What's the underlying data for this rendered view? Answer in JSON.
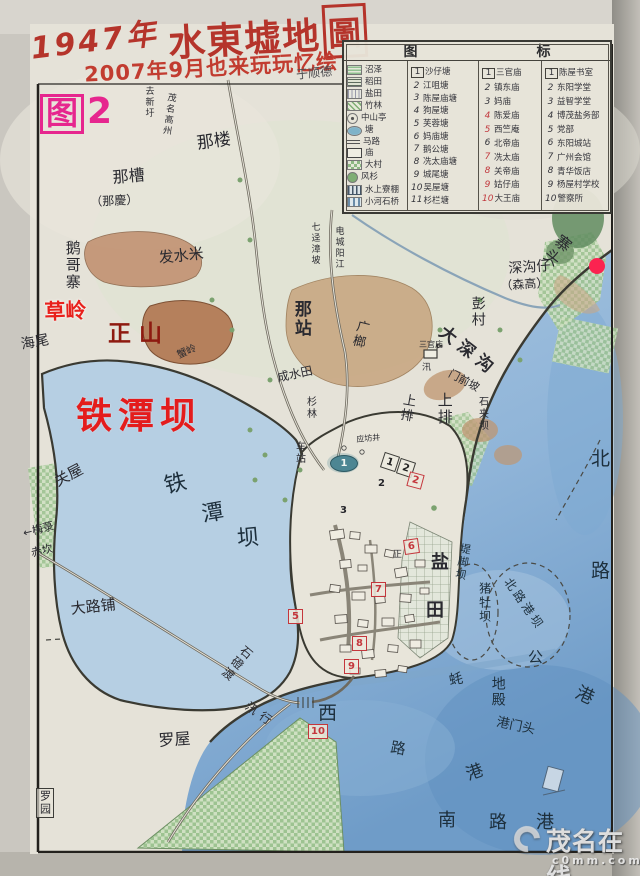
{
  "colors": {
    "paper": "#e5e2d8",
    "sea": "#9fc0dc",
    "lake": "#b6cfe3",
    "deep_sea": "#6f9cc8",
    "title_red": "#b5342b",
    "figure_magenta": "#e6268e",
    "overlay_red": "#e41c1c",
    "overlay_dark_red": "#8e1a10",
    "red_dot": "#fb2350",
    "ink": "#2a2a30"
  },
  "title": {
    "year": "1947年",
    "main": "水東墟地",
    "main_boxed": "圖",
    "subtitle": "2007年9月也来玩玩忆绘",
    "signature": "于顺德"
  },
  "figure": {
    "label": "图",
    "number": "2"
  },
  "legend": {
    "header_left": "图",
    "header_right": "标",
    "symbols": [
      {
        "icon": "marsh",
        "label": "沼泽"
      },
      {
        "icon": "paddy",
        "label": "稻田"
      },
      {
        "icon": "salt",
        "label": "盐田"
      },
      {
        "icon": "bamboo",
        "label": "竹林"
      },
      {
        "icon": "pavilion",
        "label": "中山亭"
      },
      {
        "icon": "pond",
        "label": "塘"
      },
      {
        "icon": "road",
        "label": "马路"
      },
      {
        "icon": "temple",
        "label": "庙"
      },
      {
        "icon": "village",
        "label": "大村"
      },
      {
        "icon": "fir",
        "label": "风杉"
      },
      {
        "icon": "stilt",
        "label": "水上寮棚"
      },
      {
        "icon": "bridge",
        "label": "小河石桥"
      }
    ],
    "ponds": [
      {
        "n": "1",
        "label": "沙仔塘",
        "box": true
      },
      {
        "n": "2",
        "label": "江咀塘"
      },
      {
        "n": "3",
        "label": "陈屋庙塘"
      },
      {
        "n": "4",
        "label": "狗屋塘"
      },
      {
        "n": "5",
        "label": "芙蓉塘"
      },
      {
        "n": "6",
        "label": "妈庙塘"
      },
      {
        "n": "7",
        "label": "鹅公塘"
      },
      {
        "n": "8",
        "label": "冼太庙塘"
      },
      {
        "n": "9",
        "label": "城尾塘"
      },
      {
        "n": "10",
        "label": "吴屋塘"
      },
      {
        "n": "11",
        "label": "杉栏塘"
      }
    ],
    "temples": [
      {
        "n": "1",
        "label": "三官庙",
        "box": true
      },
      {
        "n": "2",
        "label": "镇东庙"
      },
      {
        "n": "3",
        "label": "妈庙"
      },
      {
        "n": "4",
        "label": "陈爱庙",
        "red": true
      },
      {
        "n": "5",
        "label": "西竺庵",
        "red": true
      },
      {
        "n": "6",
        "label": "北帝庙"
      },
      {
        "n": "7",
        "label": "冼太庙",
        "red": true
      },
      {
        "n": "8",
        "label": "关帝庙",
        "red": true
      },
      {
        "n": "9",
        "label": "姑仔庙",
        "red": true
      },
      {
        "n": "10",
        "label": "大王庙",
        "red": true
      }
    ],
    "buildings": [
      {
        "n": "1",
        "label": "陈屋书室",
        "box": true
      },
      {
        "n": "2",
        "label": "东阳学堂"
      },
      {
        "n": "3",
        "label": "益智学堂"
      },
      {
        "n": "4",
        "label": "博茂盐务部"
      },
      {
        "n": "5",
        "label": "党部"
      },
      {
        "n": "6",
        "label": "东阳城站"
      },
      {
        "n": "7",
        "label": "广州会馆"
      },
      {
        "n": "8",
        "label": "青华饭店"
      },
      {
        "n": "9",
        "label": "杨屋村学校"
      },
      {
        "n": "10",
        "label": "警察所"
      }
    ]
  },
  "map": {
    "labels": [
      {
        "t": "那楼",
        "x": 196,
        "y": 136,
        "s": 17,
        "r": -8
      },
      {
        "t": "那槽",
        "x": 112,
        "y": 170,
        "s": 16,
        "r": -5
      },
      {
        "t": "（那慶）",
        "x": 90,
        "y": 196,
        "s": 12,
        "r": -3
      },
      {
        "t": "去新圩",
        "x": 143,
        "y": 86,
        "s": 9,
        "v": 1
      },
      {
        "t": "茂名高州",
        "x": 166,
        "y": 92,
        "s": 9,
        "v": 1,
        "r": 8
      },
      {
        "t": "鹅哥寨",
        "x": 64,
        "y": 240,
        "s": 15,
        "v": 1
      },
      {
        "t": "发水米",
        "x": 158,
        "y": 251,
        "s": 15,
        "r": -6
      },
      {
        "t": "海尾",
        "x": 20,
        "y": 338,
        "s": 14,
        "r": -10
      },
      {
        "t": "蟹岭",
        "x": 176,
        "y": 352,
        "s": 10,
        "r": -24
      },
      {
        "t": "那站",
        "x": 291,
        "y": 300,
        "s": 17,
        "v": 1,
        "b": 1
      },
      {
        "t": "七迳漳坡",
        "x": 309,
        "y": 222,
        "s": 9,
        "v": 1
      },
      {
        "t": "电城阳江",
        "x": 333,
        "y": 226,
        "s": 9,
        "v": 1
      },
      {
        "t": "广榔",
        "x": 356,
        "y": 318,
        "s": 13,
        "v": 1,
        "r": 14
      },
      {
        "t": "彭村",
        "x": 470,
        "y": 296,
        "s": 14,
        "v": 1
      },
      {
        "t": "大深沟",
        "x": 446,
        "y": 324,
        "s": 17,
        "r": 38,
        "b": 1,
        "sp": 6
      },
      {
        "t": "三官庙",
        "x": 419,
        "y": 341,
        "s": 8
      },
      {
        "t": "汛",
        "x": 422,
        "y": 364,
        "s": 9
      },
      {
        "t": "门前坡",
        "x": 452,
        "y": 368,
        "s": 11,
        "r": 28
      },
      {
        "t": "成水田",
        "x": 276,
        "y": 372,
        "s": 12,
        "r": -12
      },
      {
        "t": "杉林",
        "x": 304,
        "y": 396,
        "s": 10,
        "v": 1
      },
      {
        "t": "上排",
        "x": 402,
        "y": 392,
        "s": 13,
        "v": 1,
        "r": 10
      },
      {
        "t": "上排",
        "x": 436,
        "y": 392,
        "s": 15,
        "v": 1
      },
      {
        "t": "石夹坝",
        "x": 476,
        "y": 396,
        "s": 10,
        "v": 1
      },
      {
        "t": "寨头",
        "x": 560,
        "y": 230,
        "s": 16,
        "v": 1,
        "r": 38
      },
      {
        "t": "深沟仔",
        "x": 508,
        "y": 262,
        "s": 14,
        "r": -4
      },
      {
        "t": "（森高）",
        "x": 500,
        "y": 280,
        "s": 12,
        "r": -4
      },
      {
        "t": "铁",
        "x": 162,
        "y": 476,
        "s": 22,
        "r": -15,
        "cls": "water-ink"
      },
      {
        "t": "潭",
        "x": 200,
        "y": 504,
        "s": 22,
        "r": -10,
        "cls": "water-ink"
      },
      {
        "t": "坝",
        "x": 236,
        "y": 528,
        "s": 22,
        "r": -5,
        "cls": "water-ink"
      },
      {
        "t": "关屋",
        "x": 52,
        "y": 476,
        "s": 15,
        "r": -28
      },
      {
        "t": "←梅菉",
        "x": 22,
        "y": 528,
        "s": 11,
        "r": -14
      },
      {
        "t": "赤坎",
        "x": 30,
        "y": 548,
        "s": 11,
        "r": -14
      },
      {
        "t": "大路铺",
        "x": 70,
        "y": 602,
        "s": 15,
        "r": -6
      },
      {
        "t": "罗屋",
        "x": 158,
        "y": 733,
        "s": 16,
        "r": -4
      },
      {
        "t": "罗园",
        "x": 36,
        "y": 788,
        "s": 11,
        "v": 1,
        "cls": "boxed"
      },
      {
        "t": "石磴渡",
        "x": 245,
        "y": 643,
        "s": 12,
        "v": 1,
        "r": 40
      },
      {
        "t": "汛行",
        "x": 250,
        "y": 700,
        "s": 12,
        "r": 35,
        "sp": 5
      },
      {
        "t": "西",
        "x": 318,
        "y": 704,
        "s": 19,
        "cls": "water-ink"
      },
      {
        "t": "路",
        "x": 392,
        "y": 740,
        "s": 15,
        "r": 10,
        "cls": "water-ink"
      },
      {
        "t": "北",
        "x": 591,
        "y": 450,
        "s": 19,
        "cls": "water-ink"
      },
      {
        "t": "路",
        "x": 591,
        "y": 562,
        "s": 19,
        "cls": "water-ink"
      },
      {
        "t": "港",
        "x": 580,
        "y": 684,
        "s": 18,
        "r": 25,
        "cls": "water-ink"
      },
      {
        "t": "公",
        "x": 528,
        "y": 650,
        "s": 15,
        "cls": "water-ink"
      },
      {
        "t": "蚝",
        "x": 448,
        "y": 674,
        "s": 14,
        "r": -10,
        "cls": "water-ink"
      },
      {
        "t": "地殿",
        "x": 490,
        "y": 676,
        "s": 14,
        "v": 1,
        "cls": "water-ink"
      },
      {
        "t": "港门头",
        "x": 498,
        "y": 716,
        "s": 13,
        "r": 12,
        "cls": "water-ink"
      },
      {
        "t": "港",
        "x": 464,
        "y": 768,
        "s": 17,
        "r": -20,
        "cls": "water-ink"
      },
      {
        "t": "南",
        "x": 438,
        "y": 812,
        "s": 18,
        "cls": "water-ink"
      },
      {
        "t": "路",
        "x": 489,
        "y": 814,
        "s": 18,
        "cls": "water-ink"
      },
      {
        "t": "港",
        "x": 536,
        "y": 814,
        "s": 18,
        "cls": "water-ink"
      },
      {
        "t": "北路港坝",
        "x": 512,
        "y": 576,
        "s": 12,
        "r": 55,
        "cls": "water-ink",
        "sp": 3
      },
      {
        "t": "猪牡坝",
        "x": 478,
        "y": 582,
        "s": 12,
        "v": 1,
        "cls": "water-ink"
      },
      {
        "t": "堤脚坝",
        "x": 460,
        "y": 542,
        "s": 11,
        "v": 1,
        "r": 10,
        "cls": "water-ink"
      },
      {
        "t": "盐",
        "x": 431,
        "y": 554,
        "s": 18,
        "b": 1
      },
      {
        "t": "田",
        "x": 426,
        "y": 602,
        "s": 18,
        "b": 1
      },
      {
        "t": "车站",
        "x": 293,
        "y": 441,
        "s": 10,
        "v": 1
      },
      {
        "t": "应坊井",
        "x": 356,
        "y": 436,
        "s": 8,
        "r": -5
      },
      {
        "t": "正",
        "x": 393,
        "y": 551,
        "s": 9
      },
      {
        "t": "草岭",
        "x": 44,
        "y": 301,
        "s": 21,
        "cls": "overlay-red",
        "r": -2
      },
      {
        "t": "正山",
        "x": 108,
        "y": 322,
        "s": 23,
        "cls": "overlay-dark-red",
        "sp": 8
      },
      {
        "t": "铁潭坝",
        "x": 76,
        "y": 398,
        "s": 36,
        "cls": "overlay-big-red",
        "sp": 6
      }
    ],
    "markers": [
      {
        "type": "pond1",
        "n": "1",
        "x": 330,
        "y": 455
      },
      {
        "type": "sq",
        "n": "1",
        "x": 382,
        "y": 454,
        "r": 18
      },
      {
        "type": "sq",
        "n": "2",
        "x": 398,
        "y": 460,
        "r": 18
      },
      {
        "type": "plain",
        "n": "2",
        "x": 378,
        "y": 478
      },
      {
        "type": "plain",
        "n": "3",
        "x": 340,
        "y": 505
      },
      {
        "type": "red",
        "n": "2",
        "x": 408,
        "y": 473,
        "r": 15
      },
      {
        "type": "red",
        "n": "6",
        "x": 404,
        "y": 539,
        "r": -8
      },
      {
        "type": "red",
        "n": "7",
        "x": 371,
        "y": 582
      },
      {
        "type": "red",
        "n": "5",
        "x": 288,
        "y": 609
      },
      {
        "type": "red",
        "n": "8",
        "x": 352,
        "y": 636
      },
      {
        "type": "red",
        "n": "9",
        "x": 344,
        "y": 659
      },
      {
        "type": "red",
        "n": "10",
        "x": 308,
        "y": 724
      }
    ]
  },
  "watermark": {
    "name": "茂名在线",
    "domain": "c0mm.com"
  }
}
